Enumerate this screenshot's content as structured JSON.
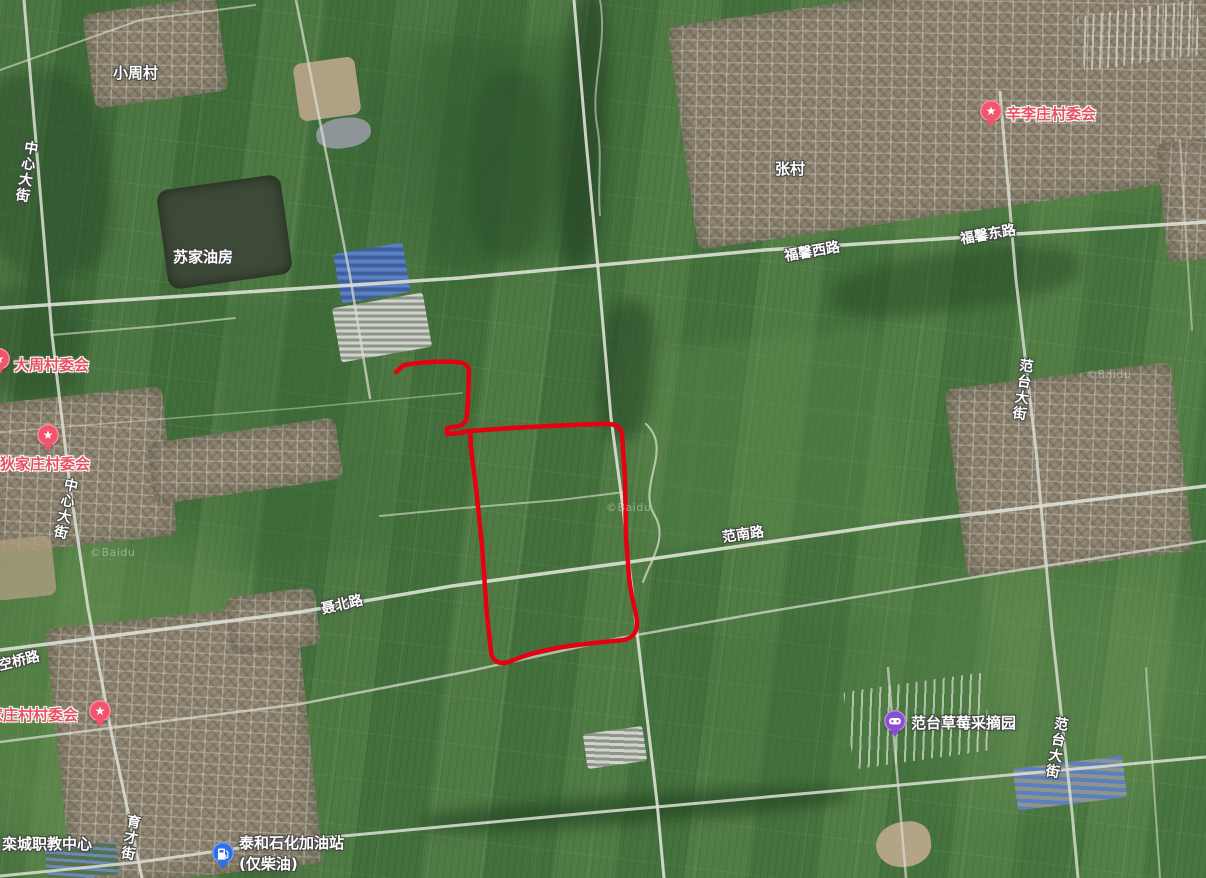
{
  "map": {
    "provider_watermark": "©Baidu",
    "view": "satellite",
    "colors": {
      "field_green": "#4a7a43",
      "road": "#dde1d6",
      "red_boundary": "#e60012",
      "poi_text_red": "#e65260",
      "pin_pink": "#f0556b",
      "pin_blue": "#2e6fe3",
      "pin_purple": "#8a4ed0"
    }
  },
  "labels": {
    "xiao_zhou_cun": "小周村",
    "zhong_xin_da_jie": "中心大街",
    "su_jia_you_fang": "苏家油房",
    "da_zhou_cun_wei_hui": "大周村委会",
    "di_jia_zhuang_cun_wei_hui": "狄家庄村委会",
    "zhang_cun": "张村",
    "xin_li_zhuang_cun_wei_hui": "辛李庄村委会",
    "fu_xin_xi_lu": "福馨西路",
    "fu_xin_dong_lu": "福馨东路",
    "fan_nan_lu": "范南路",
    "nie_bei_lu": "聂北路",
    "ling_kong_qiao_lu": "凌空桥路",
    "jia_zhuang_cun_cun_wei_hui": "家庄村村委会",
    "luan_cheng_zhi_jiao_zhong_xin": "栾城职教中心",
    "yu_cai_jie": "育才街",
    "fan_tai_da_jie": "范台大街",
    "tai_he_gas_station": "泰和石化加油站",
    "tai_he_gas_note": "(仅柴油)",
    "fan_tai_cao_mei": "范台草莓采摘园",
    "watermark": "©Baidu"
  },
  "annotation": {
    "type": "hand-drawn boundary",
    "color": "#e60012",
    "description": "red outline around farmland parcels in map center"
  }
}
